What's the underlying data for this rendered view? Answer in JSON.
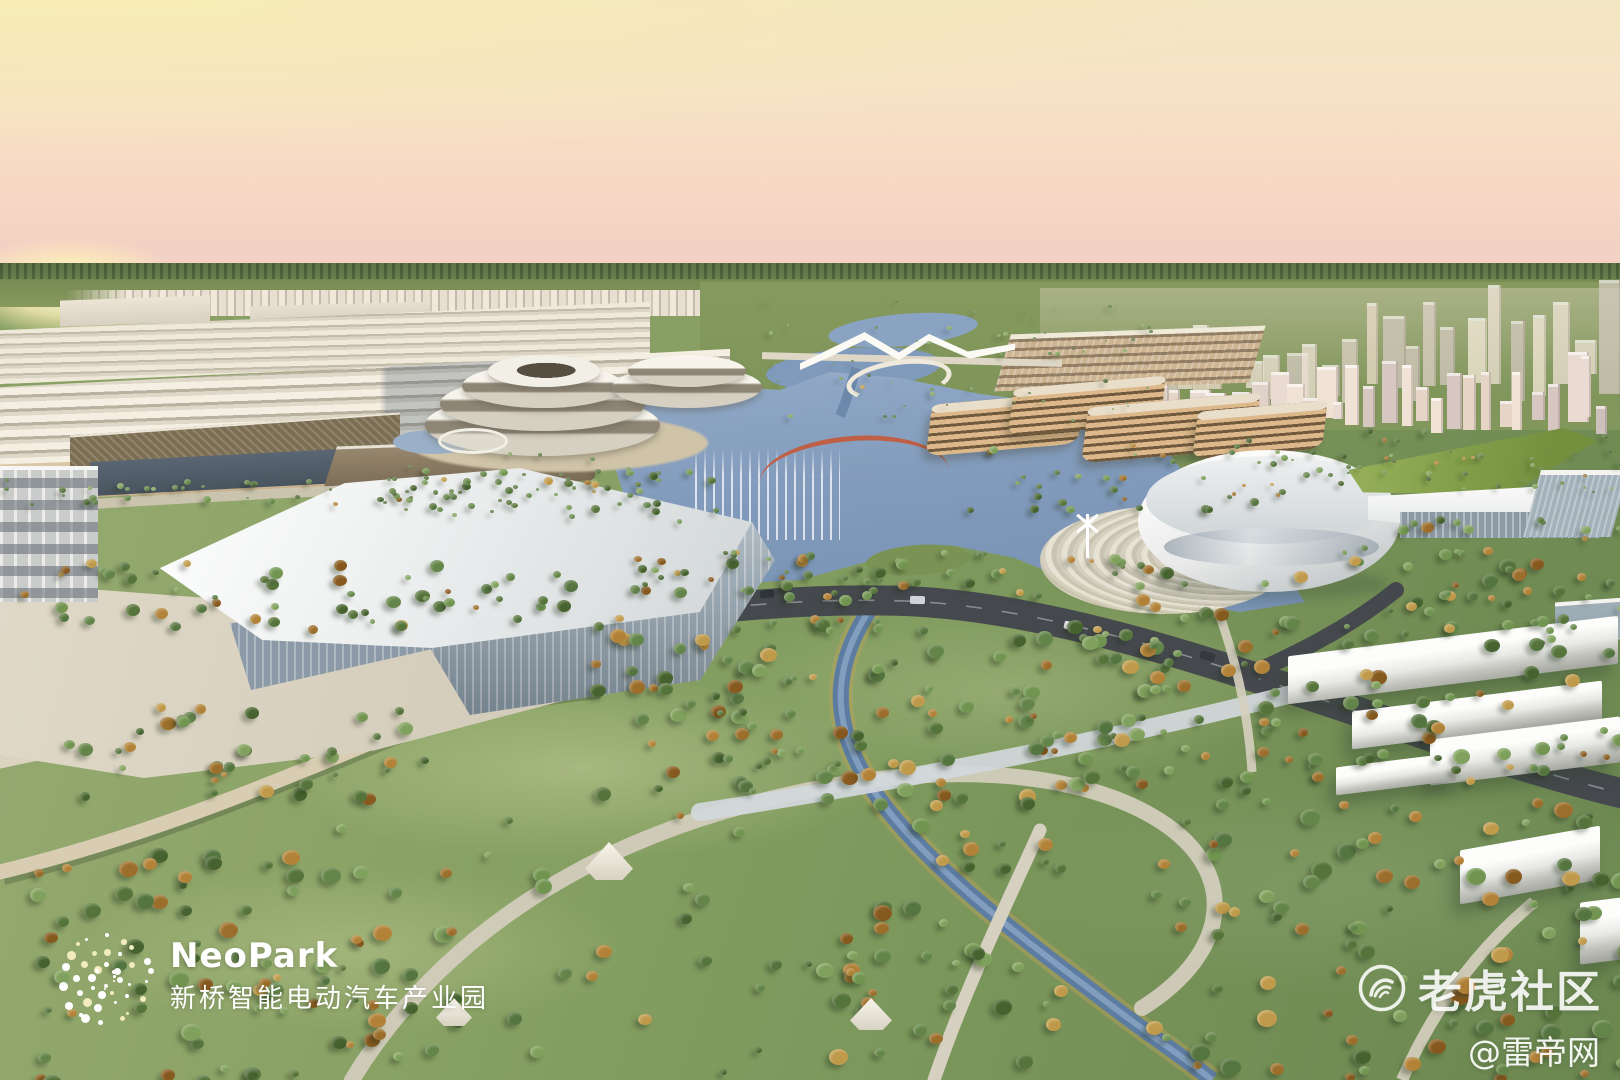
{
  "image": {
    "kind": "architectural aerial rendering",
    "subject": "NeoPark smart electric-vehicle industrial park at sunset: factory halls, spiral office buildings, lake with fountains, oval arena, distant city and a large riverside park"
  },
  "branding": {
    "logo_text": "NeoPark",
    "logo_subtitle": "新桥智能电动汽车产业园",
    "logo_mark": "dot-cluster-globe-icon",
    "text_color": "#ffffff"
  },
  "watermarks": {
    "community_label": "老虎社区",
    "community_icon": "tiger-circle-icon",
    "credit_label": "@雷帝网"
  },
  "palette": {
    "sky_top": "#f3e6c2",
    "sky_horizon": "#efcfc6",
    "sun_glow": "#fff0b9",
    "water": "#829bbc",
    "grass": "#849c60",
    "autumn_tree": "#b28238",
    "roof_white": "#f4f4f2",
    "road_dark": "#45494d",
    "factory_wall": "#dcc7a6"
  }
}
